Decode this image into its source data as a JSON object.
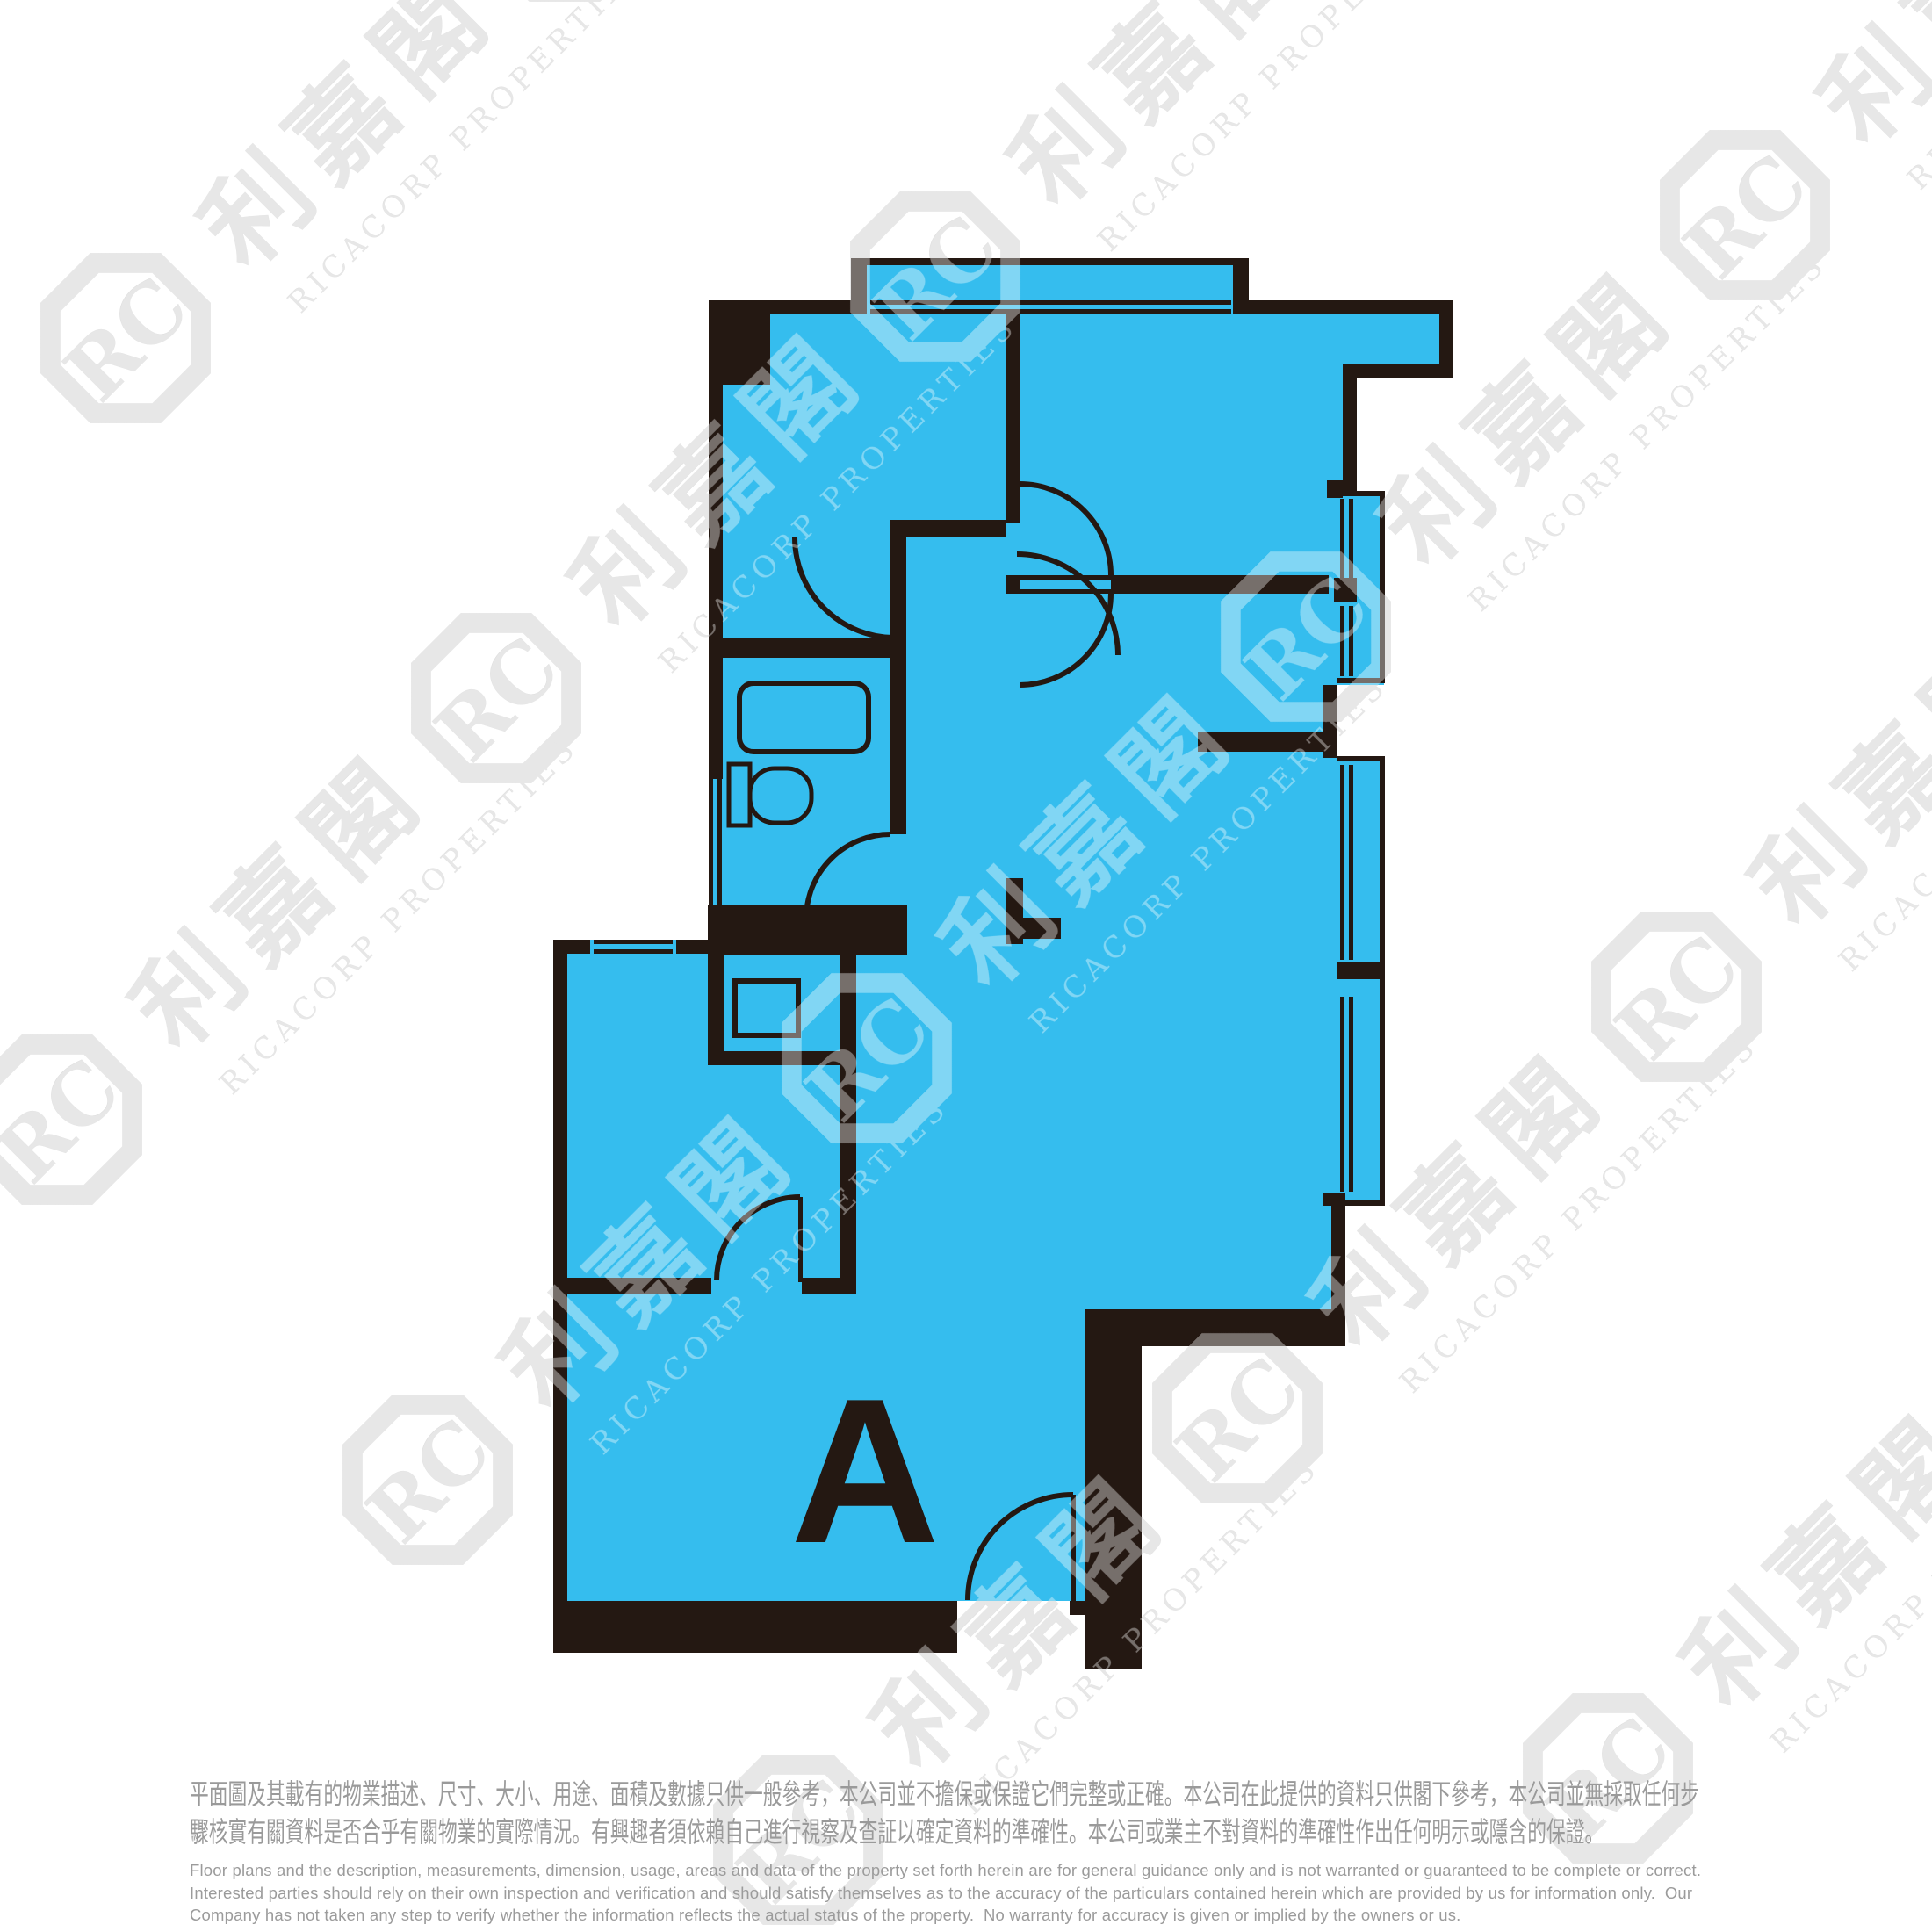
{
  "plan": {
    "unit_label": "A",
    "colors": {
      "floor_fill": "#35BDEE",
      "wall": "#241812"
    }
  },
  "watermark": {
    "logo_monogram": "RC",
    "cjk": "利嘉閣",
    "latin": "RICACORP PROPERTIES",
    "color_on_white": "#D8D8D8"
  },
  "disclaimer": {
    "text_color": "#9A9A9A",
    "zh_lines": [
      "平面圖及其載有的物業描述、尺寸、大小、用途、面積及數據只供一般參考，本公司並不擔保或保證它們完整或正確。本公司在此提供的資料只供閣下參考，本公司並無採取任何步",
      "驟核實有關資料是否合乎有關物業的實際情況。有興趣者須依賴自己進行視察及查証以確定資料的準確性。本公司或業主不對資料的準確性作出任何明示或隱含的保證。"
    ],
    "en_lines": [
      "Floor plans and the description, measurements, dimension, usage, areas and data of the property set forth herein are for general guidance only and is not warranted or guaranteed to be complete or correct.",
      "Interested parties should rely on their own inspection and verification and should satisfy themselves as to the accuracy of the particulars contained herein which are provided by us for information only.  Our",
      "Company has not taken any step to verify whether the information reflects the actual status of the property.  No warranty for accuracy is given or implied by the owners or us."
    ]
  }
}
